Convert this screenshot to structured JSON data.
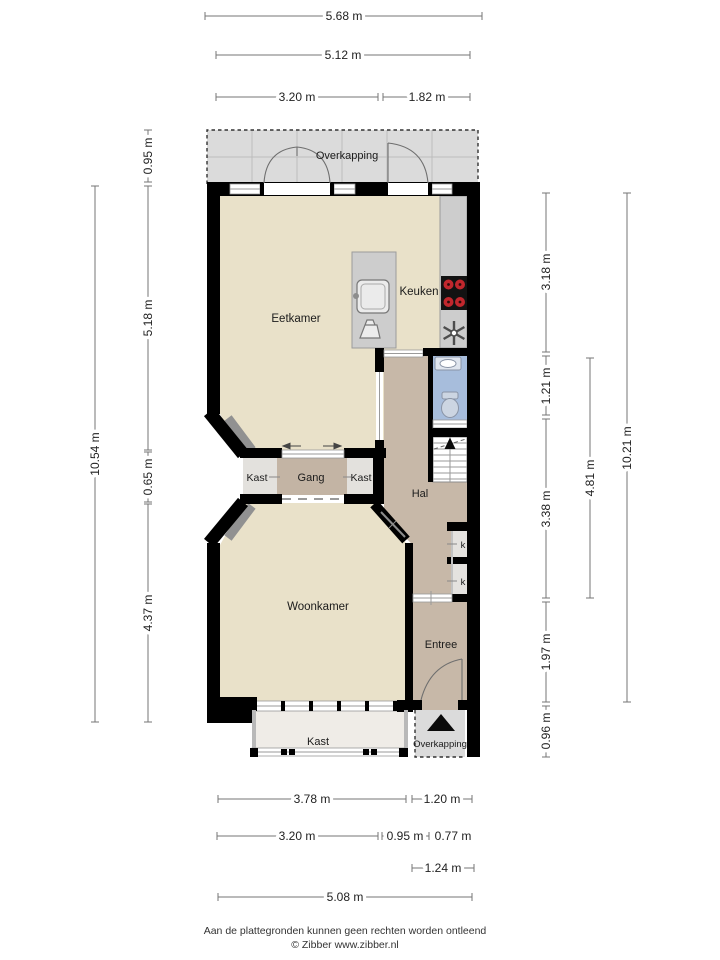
{
  "footer": {
    "disclaimer": "Aan de plattegronden kunnen geen rechten worden ontleend",
    "credit": "© Zibber www.zibber.nl"
  },
  "icons": {
    "entrance-arrow": "black upward triangle marking entrance in porch",
    "ventilation-fan": "six-spoke fan symbol",
    "cooktop": "black hob with four red burners",
    "stairs-up-arrow": "arrow marking stair direction"
  },
  "colors": {
    "wall": "#000000",
    "floor_beige": "#e9e1c9",
    "floor_hall": "#c7b8a8",
    "floor_gang": "#c3b4a4",
    "floor_closet": "#e3e1dd",
    "floor_bath": "#a7bddc",
    "overkapping_grey": "#dbdbdb",
    "counter_grey": "#cdcdcd",
    "burner_red": "#c1272d"
  },
  "room_labels": [
    {
      "label": "Overkapping",
      "x": 347,
      "y": 159,
      "size": 11
    },
    {
      "label": "Eetkamer",
      "x": 296,
      "y": 322,
      "size": 11.5
    },
    {
      "label": "Keuken",
      "x": 419,
      "y": 295,
      "size": 11.5
    },
    {
      "label": "Kast",
      "x": 257,
      "y": 481,
      "size": 10.5
    },
    {
      "label": "Gang",
      "x": 311,
      "y": 481,
      "size": 11
    },
    {
      "label": "Kast",
      "x": 361,
      "y": 481,
      "size": 10.5
    },
    {
      "label": "Hal",
      "x": 420,
      "y": 497,
      "size": 11
    },
    {
      "label": "Woonkamer",
      "x": 318,
      "y": 610,
      "size": 11.5
    },
    {
      "label": "Entree",
      "x": 441,
      "y": 648,
      "size": 11
    },
    {
      "label": "k",
      "x": 463,
      "y": 548,
      "size": 9.5
    },
    {
      "label": "k",
      "x": 463,
      "y": 585,
      "size": 9.5
    },
    {
      "label": "Kast",
      "x": 318,
      "y": 745,
      "size": 11
    },
    {
      "label": "Overkapping",
      "x": 440,
      "y": 747,
      "size": 9.5
    }
  ],
  "dimensions": [
    {
      "label": "5.68 m",
      "x1": 205,
      "y1": 16,
      "x2": 482,
      "y2": 16,
      "lx": 344,
      "ly": 20,
      "rot": false
    },
    {
      "label": "5.12 m",
      "x1": 216,
      "y1": 55,
      "x2": 470,
      "y2": 55,
      "lx": 343,
      "ly": 59,
      "rot": false
    },
    {
      "label": "3.20 m",
      "x1": 216,
      "y1": 97,
      "x2": 378,
      "y2": 97,
      "lx": 297,
      "ly": 101,
      "rot": false
    },
    {
      "label": "1.82 m",
      "x1": 383,
      "y1": 97,
      "x2": 470,
      "y2": 97,
      "lx": 427,
      "ly": 101,
      "rot": false
    },
    {
      "label": "0.95 m",
      "x1": 148,
      "y1": 130,
      "x2": 148,
      "y2": 182,
      "lx": 152,
      "ly": 156,
      "rot": true
    },
    {
      "label": "5.18 m",
      "x1": 148,
      "y1": 186,
      "x2": 148,
      "y2": 450,
      "lx": 152,
      "ly": 318,
      "rot": true
    },
    {
      "label": "0.65 m",
      "x1": 148,
      "y1": 452,
      "x2": 148,
      "y2": 502,
      "lx": 152,
      "ly": 477,
      "rot": true
    },
    {
      "label": "4.37 m",
      "x1": 148,
      "y1": 504,
      "x2": 148,
      "y2": 722,
      "lx": 152,
      "ly": 613,
      "rot": true
    },
    {
      "label": "10.54 m",
      "x1": 95,
      "y1": 186,
      "x2": 95,
      "y2": 722,
      "lx": 99,
      "ly": 454,
      "rot": true
    },
    {
      "label": "3.18 m",
      "x1": 546,
      "y1": 193,
      "x2": 546,
      "y2": 352,
      "lx": 550,
      "ly": 272,
      "rot": true
    },
    {
      "label": "1.21 m",
      "x1": 546,
      "y1": 356,
      "x2": 546,
      "y2": 415,
      "lx": 550,
      "ly": 386,
      "rot": true
    },
    {
      "label": "3.38 m",
      "x1": 546,
      "y1": 419,
      "x2": 546,
      "y2": 598,
      "lx": 550,
      "ly": 509,
      "rot": true
    },
    {
      "label": "1.97 m",
      "x1": 546,
      "y1": 602,
      "x2": 546,
      "y2": 702,
      "lx": 550,
      "ly": 652,
      "rot": true
    },
    {
      "label": "0.96 m",
      "x1": 546,
      "y1": 706,
      "x2": 546,
      "y2": 757,
      "lx": 550,
      "ly": 731,
      "rot": true
    },
    {
      "label": "4.81 m",
      "x1": 590,
      "y1": 358,
      "x2": 590,
      "y2": 598,
      "lx": 594,
      "ly": 478,
      "rot": true
    },
    {
      "label": "10.21 m",
      "x1": 627,
      "y1": 193,
      "x2": 627,
      "y2": 702,
      "lx": 631,
      "ly": 448,
      "rot": true
    },
    {
      "label": "3.78 m",
      "x1": 218,
      "y1": 799,
      "x2": 406,
      "y2": 799,
      "lx": 312,
      "ly": 803,
      "rot": false
    },
    {
      "label": "1.20 m",
      "x1": 412,
      "y1": 799,
      "x2": 472,
      "y2": 799,
      "lx": 442,
      "ly": 803,
      "rot": false
    },
    {
      "label": "3.20 m",
      "x1": 217,
      "y1": 836,
      "x2": 378,
      "y2": 836,
      "lx": 297,
      "ly": 840,
      "rot": false
    },
    {
      "label": "0.95 m",
      "x1": 382,
      "y1": 836,
      "x2": 429,
      "y2": 836,
      "lx": 405,
      "ly": 840,
      "rot": false
    },
    {
      "label": "0.77 m",
      "x1": 433,
      "y1": 836,
      "x2": 472,
      "y2": 836,
      "lx": 453,
      "ly": 840,
      "rot": false
    },
    {
      "label": "1.24 m",
      "x1": 412,
      "y1": 868,
      "x2": 474,
      "y2": 868,
      "lx": 443,
      "ly": 872,
      "rot": false
    },
    {
      "label": "5.08 m",
      "x1": 218,
      "y1": 897,
      "x2": 472,
      "y2": 897,
      "lx": 345,
      "ly": 901,
      "rot": false
    }
  ]
}
